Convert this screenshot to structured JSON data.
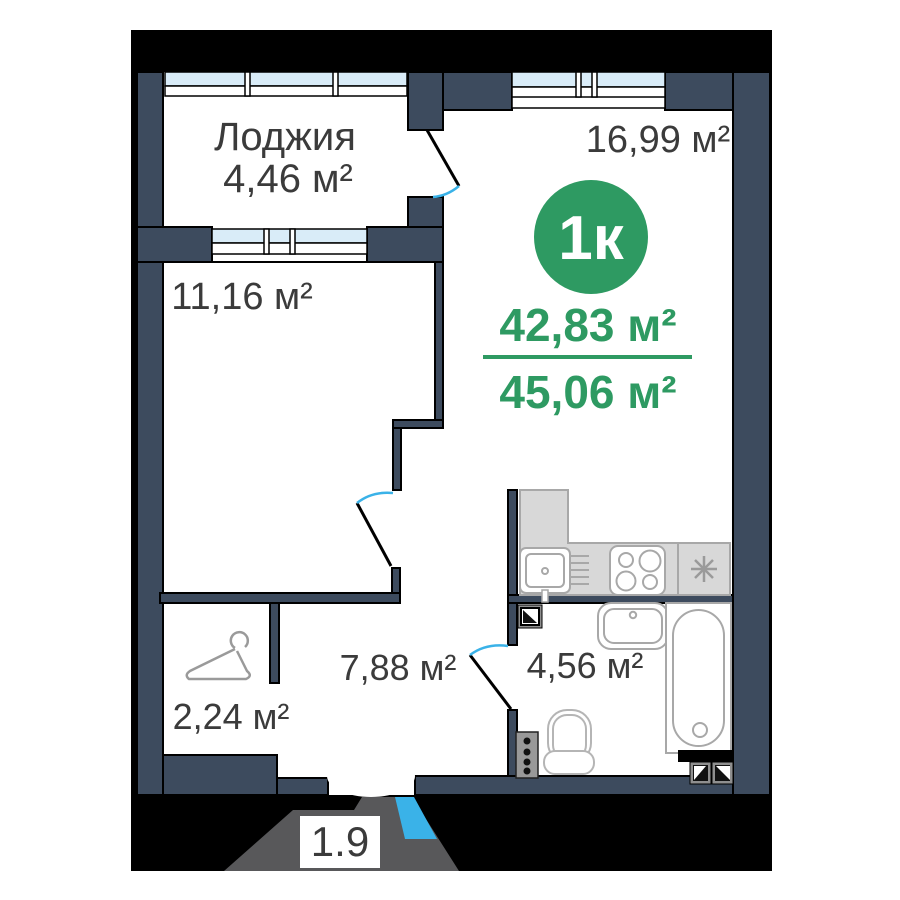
{
  "badge": {
    "label": "1к"
  },
  "areas": {
    "living": "42,83 м²",
    "total": "45,06 м²"
  },
  "rooms": {
    "loggia": {
      "name": "Лоджия",
      "area": "4,46 м²"
    },
    "bedroom": {
      "area": "11,16 м²"
    },
    "living_room": {
      "area": "16,99 м²"
    },
    "hallway": {
      "area": "7,88 м²"
    },
    "bathroom": {
      "area": "4,56 м²"
    },
    "wardrobe": {
      "area": "2,24 м²"
    }
  },
  "entry": {
    "label": "1.9"
  },
  "icons": {
    "wardrobe": "hanger-icon",
    "kitchen_fridge": "asterisk-icon",
    "kitchen_sink": "sink-icon",
    "kitchen_stove": "stove-icon",
    "bath_tub": "bathtub-icon",
    "bath_sink": "washbasin-icon",
    "bath_toilet": "toilet-icon",
    "vents": "ventilation-shaft-icon"
  },
  "colors": {
    "wall": "#3d4b5e",
    "accent_green": "#2e9a62",
    "door_blue": "#3ab2e8",
    "glazing": "#d9ecf8",
    "vestibule_gray": "#58585a"
  }
}
